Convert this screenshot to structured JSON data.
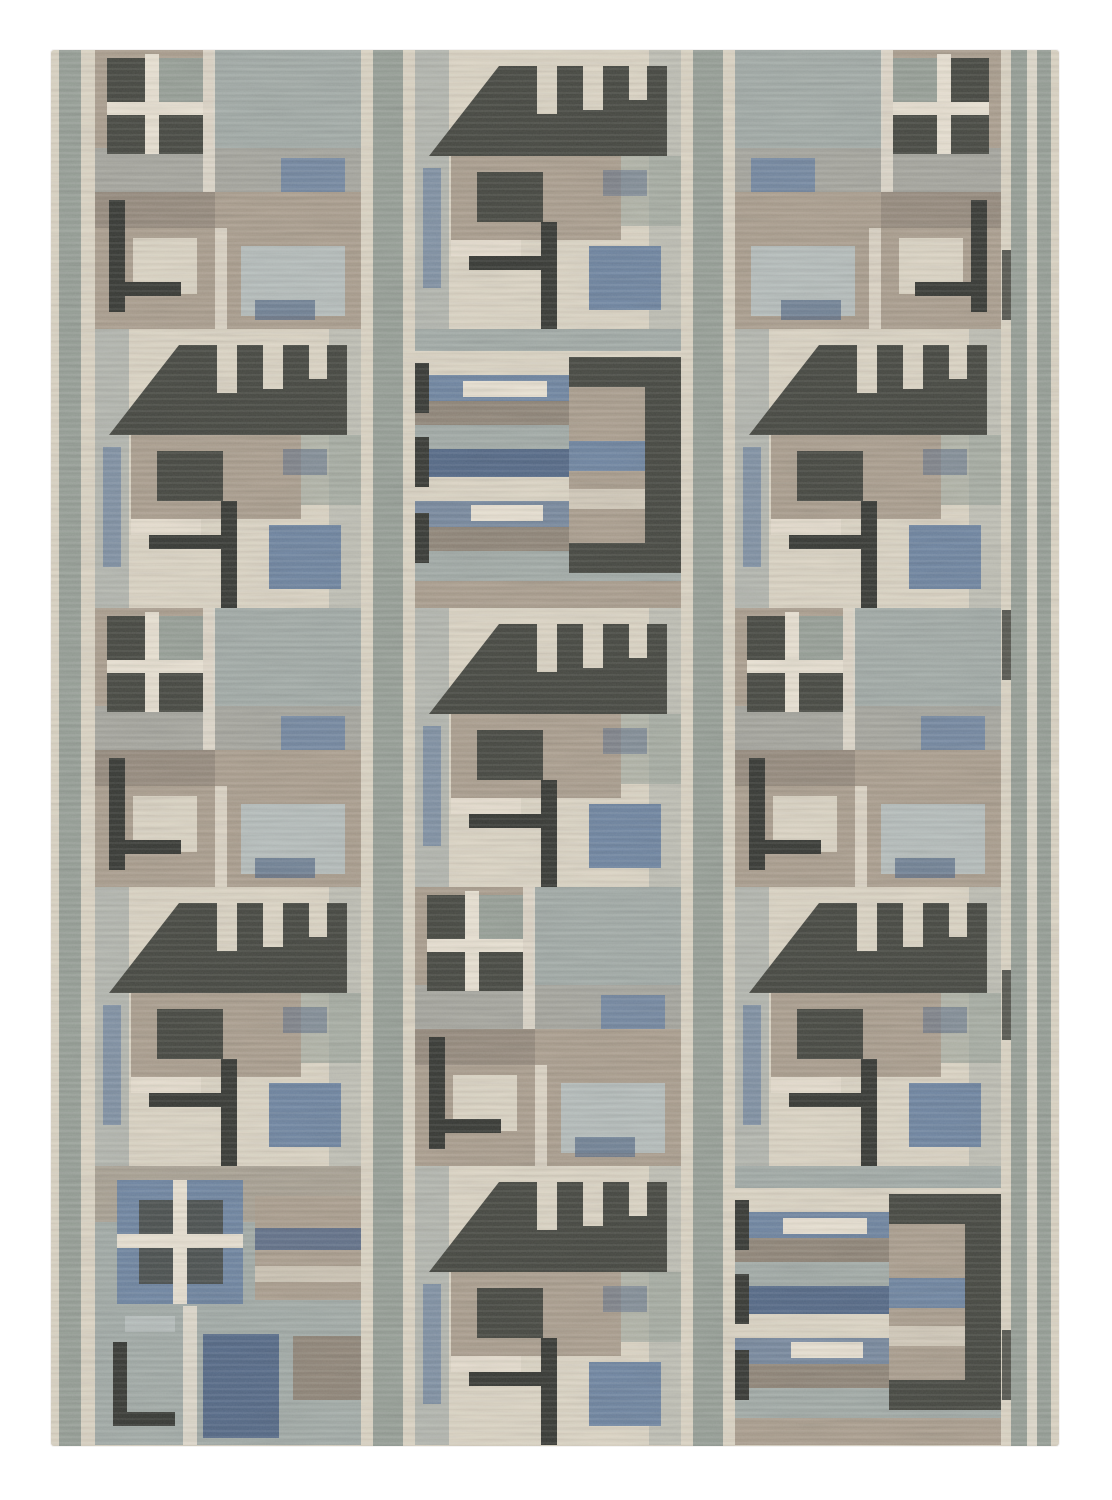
{
  "image": {
    "description": "Hand-woven flat-weave wool area rug with a Scandinavian-modernist geometric patchwork pattern in cream, taupe, grey-green, slate blue and charcoal, photographed flat on a plain white background",
    "object": "area rug",
    "style": "mid-century Scandinavian geometric patchwork",
    "background": "plain white"
  },
  "palette": {
    "white_bg": "#ffffff",
    "cream": "#dcd4c3",
    "cream_light": "#e9e1d1",
    "taupe": "#a89b8a",
    "taupe_dark": "#8c8173",
    "grey_green": "#939c93",
    "grey_blue": "#9fa8a4",
    "pale_blue": "#b4bcba",
    "slate_blue": "#68809e",
    "steel_blue": "#4c6282",
    "charcoal": "#3b3d36",
    "charcoal_deep": "#2b2d28"
  },
  "rug": {
    "motif_legend": {
      "window": "dark four-pane window square crossed by cream mullions on a taupe field",
      "roof": "charcoal hip-roof silhouette with cream notches along the top and a slanted left edge, over striped blocks with a dark T-line and slate blue square",
      "stripes": "horizontal woven bands of taupe, blue and cream with a charcoal frame open to one side and small cream tabs",
      "blue_window": "slate-blue framed window with charcoal panes, blue vertical bar and dark L-line"
    },
    "border": "grey-green vertical guard stripes with cream pinstripes along both sides and between columns",
    "grid": {
      "tile_width": 266,
      "tile_height": 279,
      "rows": 5,
      "columns": [
        {
          "x": 44,
          "tiles": [
            "window",
            "roof",
            "window",
            "roof",
            "blue_window"
          ]
        },
        {
          "x": 364,
          "tiles": [
            "roof",
            "stripes",
            "roof",
            "window",
            "roof"
          ]
        },
        {
          "x": 684,
          "tiles": [
            "window_flipped",
            "roof",
            "window",
            "roof",
            "stripes"
          ]
        }
      ]
    }
  }
}
